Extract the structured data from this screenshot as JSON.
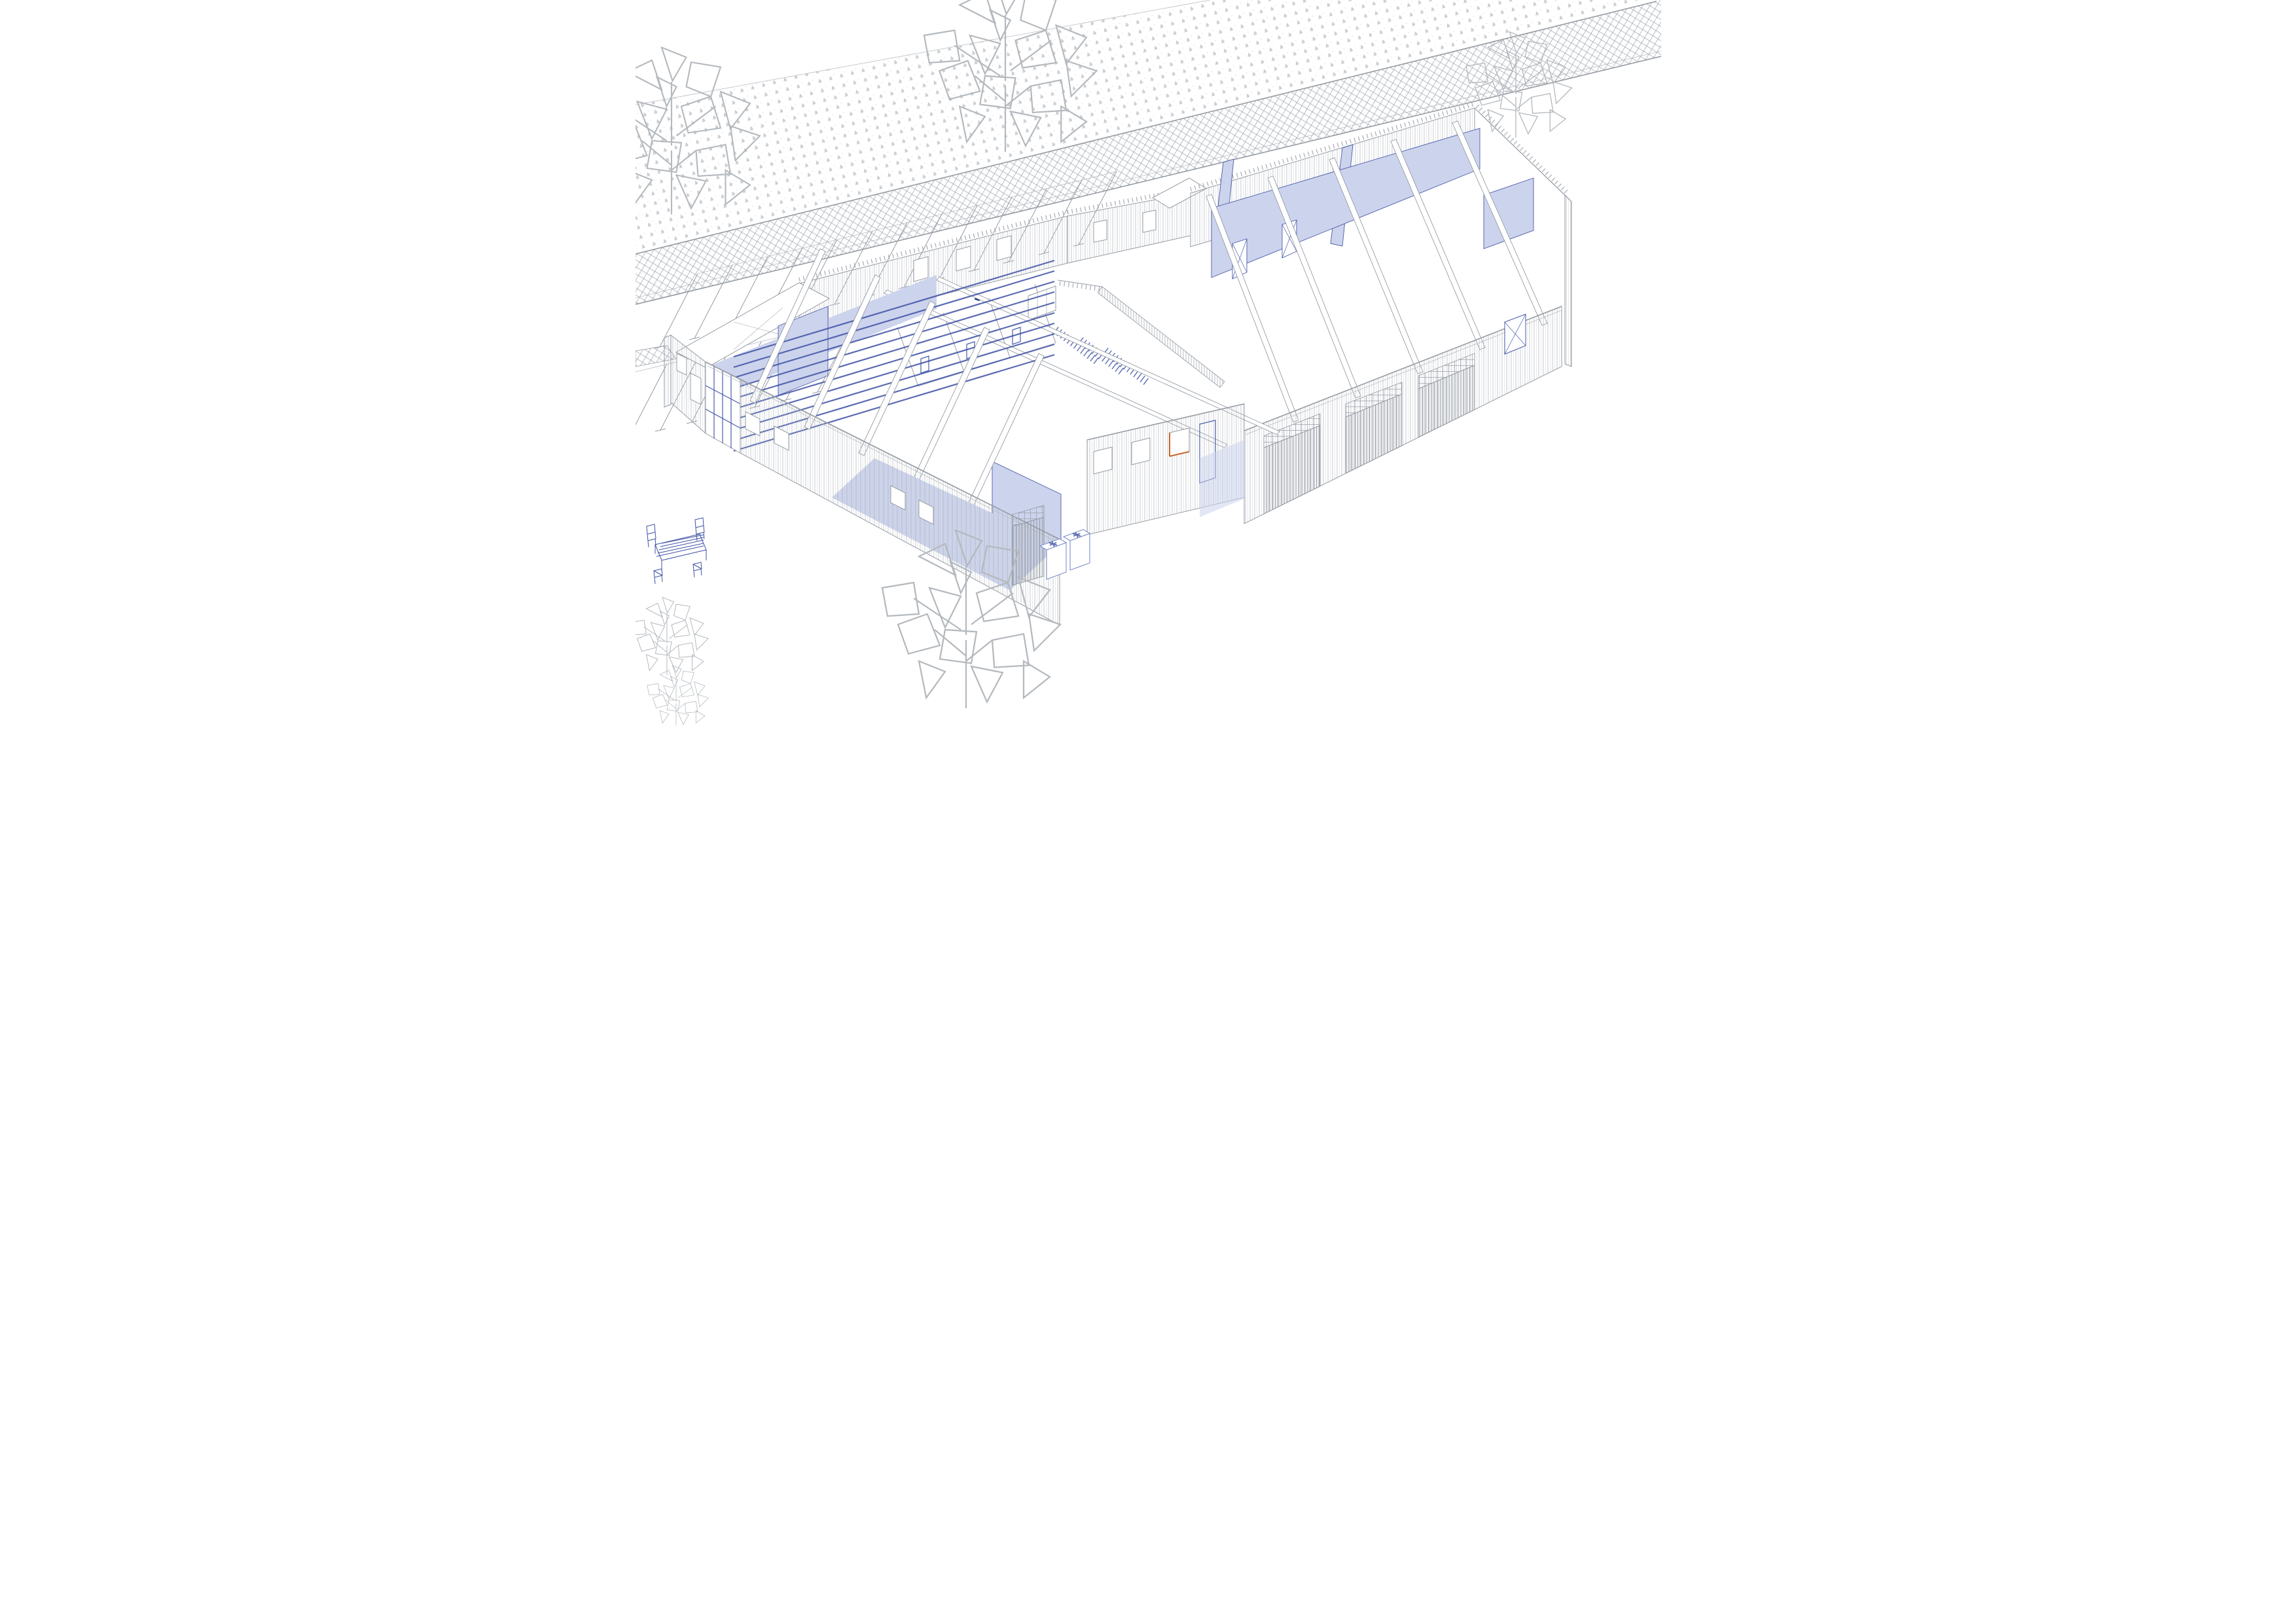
{
  "title": "Axonometric cutaway drawing of a single-storey timber building with site",
  "colors": {
    "paper": "#ffffff",
    "line": "#969ca4",
    "line_light": "#b8bdc3",
    "blue": "#4a5cab",
    "blue_strong": "#3e51a5",
    "blue_fill": "#ccd3ec",
    "navy": "#1e3a8c",
    "orange": "#c4672f",
    "tree": "#b4b9be"
  },
  "scene": {
    "site": {
      "grass_band": "stippled grass verge running diagonally across the top left",
      "path_band": "crosshatched pavement strip below the grass verge",
      "road_spur": "small crosshatched kerb strip meeting the west gable",
      "parking": {
        "rows": 2,
        "stalls_row_upper": 13,
        "stalls_row_lower": 8,
        "marking_style": "T-ended bay dividers"
      },
      "trees": 6,
      "patio": {
        "tables": 1,
        "chairs": 4,
        "color": "blue"
      }
    },
    "building": {
      "view": "cutaway axonometric, roof removed over most rooms",
      "wings": [
        "left hall wing with exposed beam and joist grid",
        "central service block with lockers and stair",
        "right halls wing"
      ],
      "highlighted_elements": "selected walls and floor slabs tinted light blue",
      "left_wing": {
        "glazed_curtain_bays": 3,
        "front_windows": 4,
        "garage_doors": 1,
        "roof_beams": 5,
        "blue_joists": 10
      },
      "central_block": {
        "front_windows": 3,
        "orange_framed_window": 1,
        "blue_door": 1,
        "locker_rows": 3,
        "stair": "hatched balustrade ramp"
      },
      "right_wing": {
        "garage_doors": 3,
        "transom_grids": 3,
        "blue_cross_wall_doors": 2,
        "orange_framed_windows": 2,
        "x_braced_window": 1,
        "roof_beams": 5,
        "sloped_roof_end": true
      },
      "hvac_units": 2
    }
  }
}
